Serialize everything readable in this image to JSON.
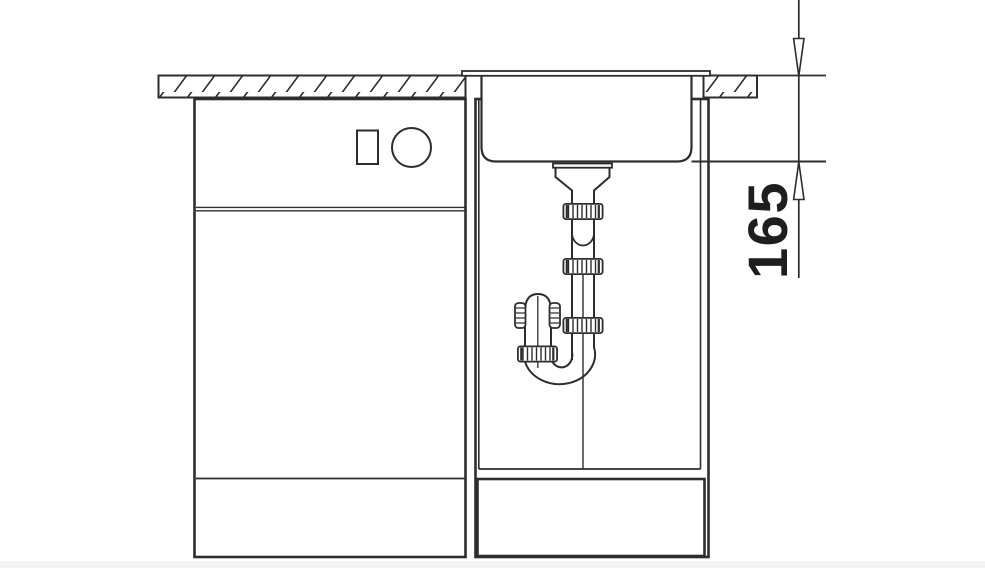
{
  "page": {
    "background_color": "#ffffff",
    "bottom_strip_color": "#f4f4f5"
  },
  "diagram": {
    "type": "technical-line-drawing",
    "subject": "kitchen sink base cabinet side section with undermount bowl and drain trap",
    "line_color": "#2d2d2d",
    "dimension": {
      "label": "165",
      "orientation": "vertical",
      "from": "worktop-top-surface",
      "to": "bowl-bottom"
    },
    "parts": [
      "worktop-hatched",
      "appliance-cabinet",
      "control-square",
      "control-knob",
      "appliance-door",
      "plinth",
      "sink-cabinet",
      "sink-bowl",
      "bowl-rim",
      "drain-flange",
      "drain-funnel",
      "tailpipe",
      "compression-nut",
      "telescopic-joint",
      "cleanout-cap",
      "s-trap-bend",
      "drain-centerline",
      "plinth-drawer-panel",
      "dimension-line",
      "dimension-arrows"
    ]
  }
}
